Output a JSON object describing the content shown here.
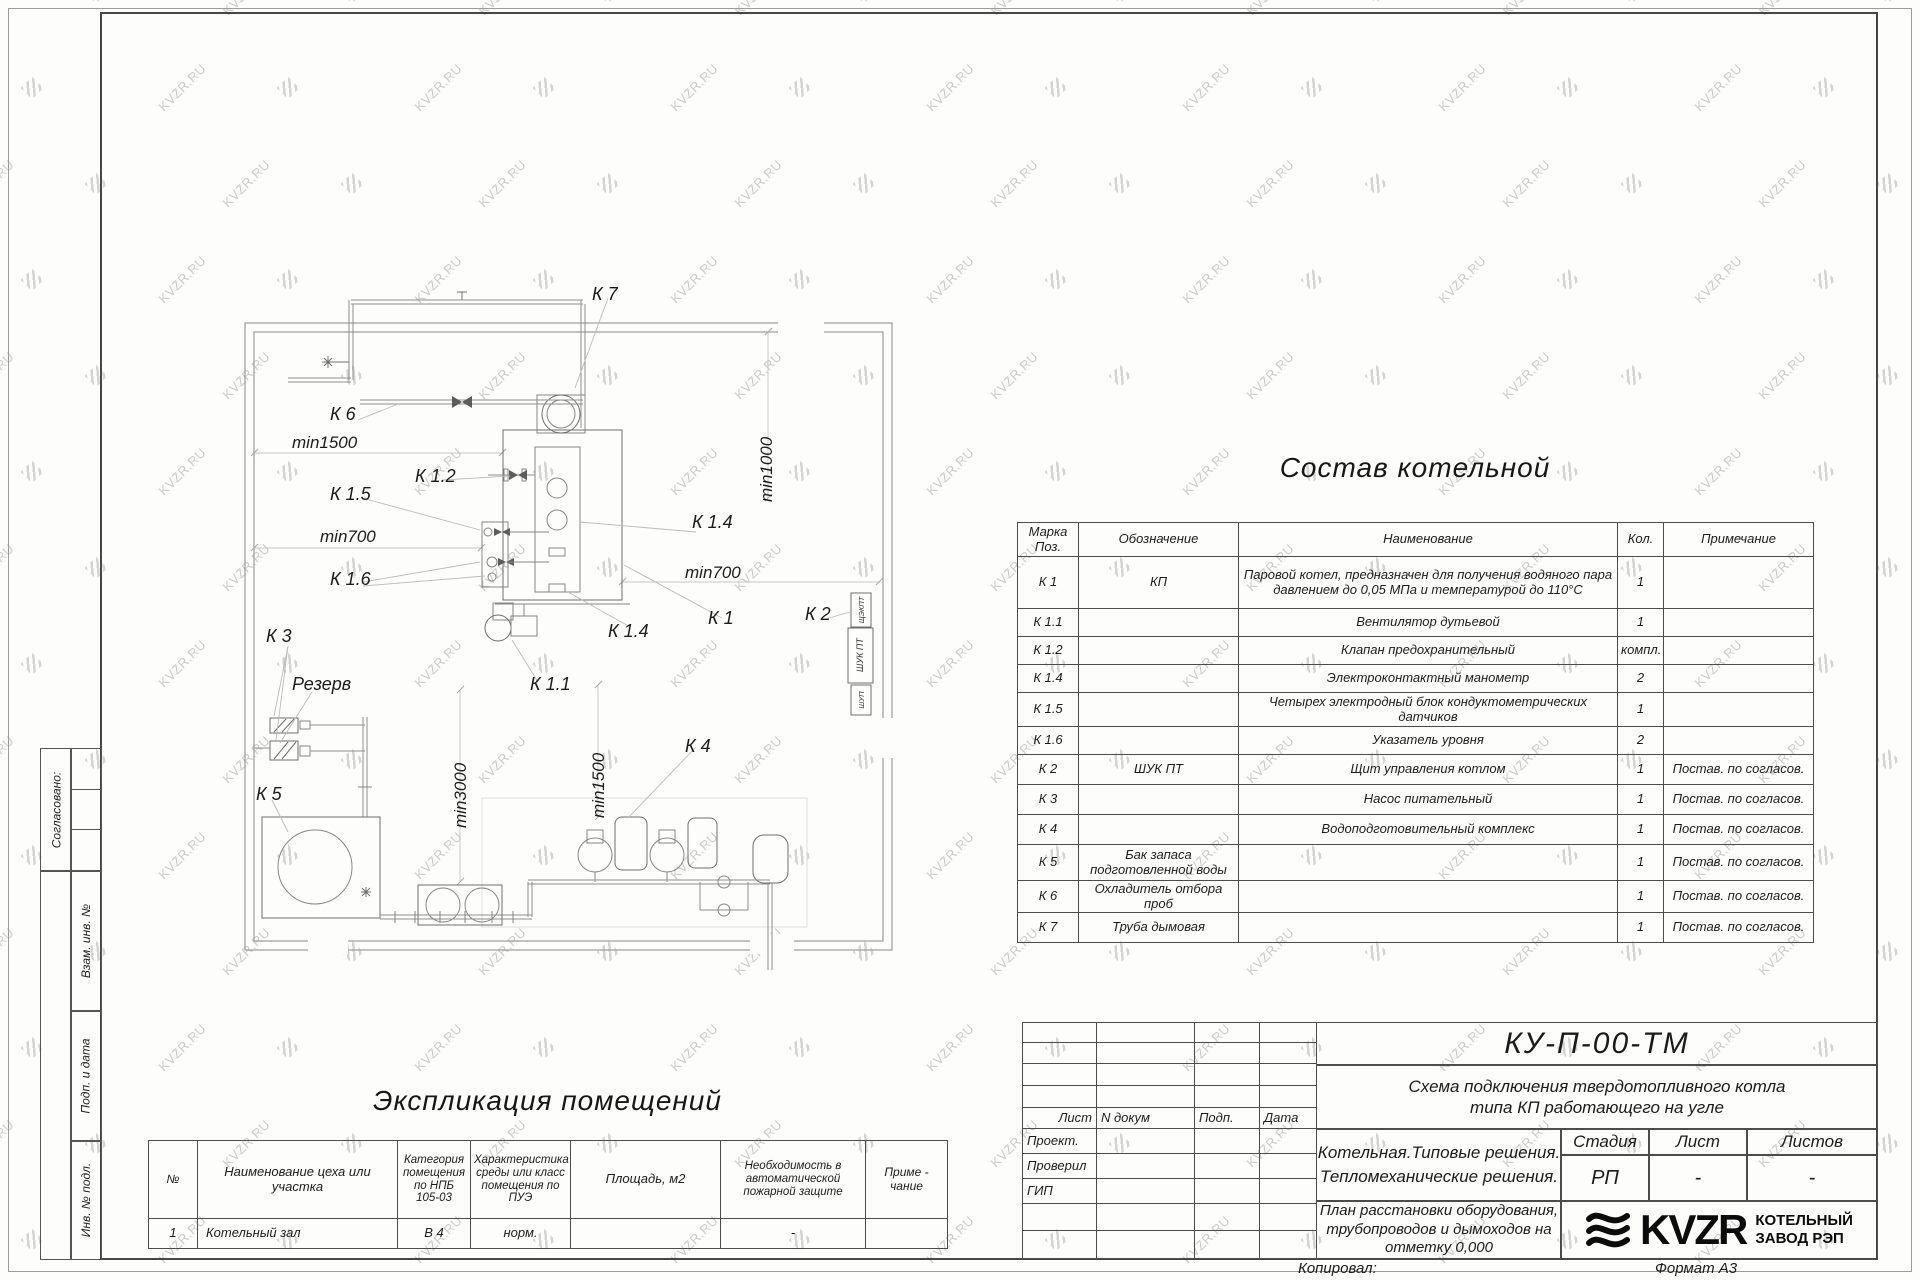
{
  "watermark": {
    "text": "KVZR.RU"
  },
  "plan": {
    "labels": {
      "k7": "К 7",
      "k6": "К 6",
      "min1500_h": "min1500",
      "k12": "К 1.2",
      "k15": "К 1.5",
      "min700_left": "min700",
      "k16": "К 1.6",
      "k14_right": "К 1.4",
      "min700_right": "min700",
      "min1000_v": "min1000",
      "k2": "К 2",
      "k1": "К 1",
      "k14_bottom": "К 1.4",
      "k3": "К 3",
      "reserve": "Резерв",
      "k11": "К 1.1",
      "min1500_v": "min1500",
      "min3000_v": "min3000",
      "k4": "К 4",
      "k5": "К 5",
      "cab1": "ЩЭКПТ",
      "cab2": "ШУК ПТ",
      "cab3": "ШУП"
    }
  },
  "composition": {
    "title": "Состав котельной",
    "headers": {
      "mark": "Марка Поз.",
      "sign": "Обозначение",
      "name": "Наименование",
      "qty": "Кол.",
      "note": "Примечание"
    },
    "rows": [
      {
        "mark": "К 1",
        "sign": "КП",
        "name": "Паровой котел, предназначен для получения водяного пара давлением до 0,05 МПа и температурой до 110°С",
        "qty": "1",
        "note": ""
      },
      {
        "mark": "К 1.1",
        "sign": "",
        "name": "Вентилятор дутьевой",
        "qty": "1",
        "note": ""
      },
      {
        "mark": "К 1.2",
        "sign": "",
        "name": "Клапан предохранительный",
        "qty": "компл.",
        "note": ""
      },
      {
        "mark": "К 1.4",
        "sign": "",
        "name": "Электроконтактный манометр",
        "qty": "2",
        "note": ""
      },
      {
        "mark": "К 1.5",
        "sign": "",
        "name": "Четырех электродный блок кондуктометрических датчиков",
        "qty": "1",
        "note": ""
      },
      {
        "mark": "К 1.6",
        "sign": "",
        "name": "Указатель уровня",
        "qty": "2",
        "note": ""
      },
      {
        "mark": "К 2",
        "sign": "ШУК ПТ",
        "name": "Щит управления котлом",
        "qty": "1",
        "note": "Постав. по согласов."
      },
      {
        "mark": "К 3",
        "sign": "",
        "name": "Насос питательный",
        "qty": "1",
        "note": "Постав. по согласов."
      },
      {
        "mark": "К 4",
        "sign": "",
        "name": "Водоподготовительный комплекс",
        "qty": "1",
        "note": "Постав. по согласов."
      },
      {
        "mark": "К 5",
        "sign": "Бак запаса подготовленной воды",
        "name": "",
        "qty": "1",
        "note": "Постав. по согласов."
      },
      {
        "mark": "К 6",
        "sign": "Охладитель отбора проб",
        "name": "",
        "qty": "1",
        "note": "Постав. по согласов."
      },
      {
        "mark": "К 7",
        "sign": "Труба дымовая",
        "name": "",
        "qty": "1",
        "note": "Постав. по согласов."
      }
    ]
  },
  "explication": {
    "title": "Экспликация помещений",
    "headers": [
      "№",
      "Наименование цеха или участка",
      "Категория помещения по НПБ 105-03",
      "Характеристика среды или класс помещения по ПУЭ",
      "Площадь, м2",
      "Необходимость в автоматической пожарной защите",
      "Приме - чание"
    ],
    "row": [
      "1",
      "Котельный зал",
      "В 4",
      "норм.",
      "",
      "-",
      ""
    ]
  },
  "stamp_left": {
    "approved": "Согласовано:",
    "alt_inv": "Взам. инв. №",
    "sign_date": "Подп. и дата",
    "inv_orig": "Инв. № подл."
  },
  "title_block": {
    "doc_number": "КУ-П-00-ТМ",
    "subtitle_line1": "Схема подключения твердотопливного котла",
    "subtitle_line2": "типа КП работающего на угле",
    "cols": {
      "sheet": "Лист",
      "doc": "N докум",
      "sign": "Подп.",
      "date": "Дата"
    },
    "roles": [
      "Проект.",
      "Проверил",
      "ГИП"
    ],
    "project_line1": "Котельная.Типовые решения.",
    "project_line2": "Тепломеханические решения.",
    "stage_label": "Стадия",
    "sheet_label": "Лист",
    "sheets_label": "Листов",
    "stage": "РП",
    "sheet": "-",
    "sheets": "-",
    "plan_line1": "План расстановки оборудования,",
    "plan_line2": "трубопроводов и дымоходов на",
    "plan_line3": "отметку 0,000",
    "logo_text": "KVZR",
    "company_line1": "КОТЕЛЬНЫЙ",
    "company_line2": "ЗАВОД РЭП"
  },
  "footer": {
    "copied": "Копировал:",
    "format": "Формат А3"
  }
}
